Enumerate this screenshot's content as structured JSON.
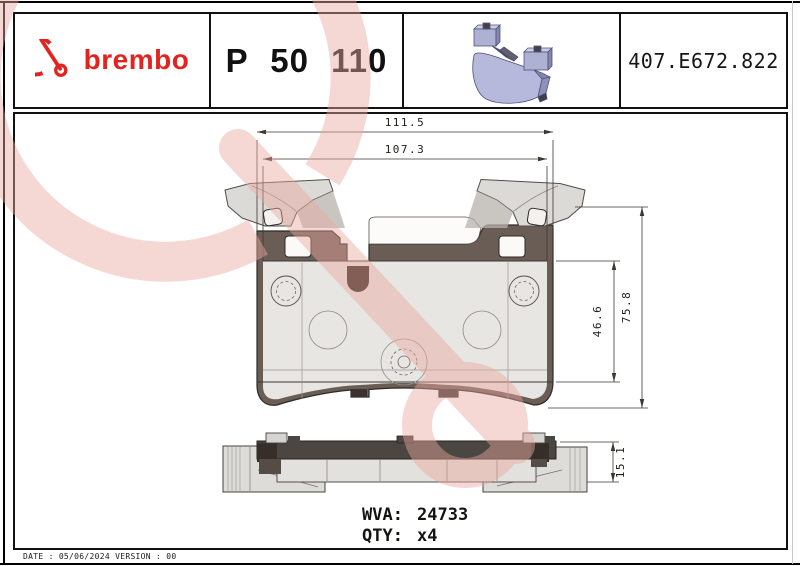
{
  "header": {
    "brand_wordmark": "brembo",
    "part_number": "P 50 110",
    "catalog_code": "407.E672.822"
  },
  "drawing": {
    "dim_width_outer": "111.5",
    "dim_width_inner": "107.3",
    "dim_height_total": "75.8",
    "dim_height_pad": "46.6",
    "dim_thickness": "15.1",
    "wva_label": "WVA:",
    "wva_value": "24733",
    "qty_label": "QTY:",
    "qty_value": "x4"
  },
  "footer": "DATE : 05/06/2024 VERSION : 00",
  "colors": {
    "brand_red": "#e2231f",
    "watermark_pink": "#eba89f",
    "backing_plate": "#6a5d56",
    "friction_material": "#e8e6e2",
    "illustration_lavender": "#b6b8dc"
  }
}
